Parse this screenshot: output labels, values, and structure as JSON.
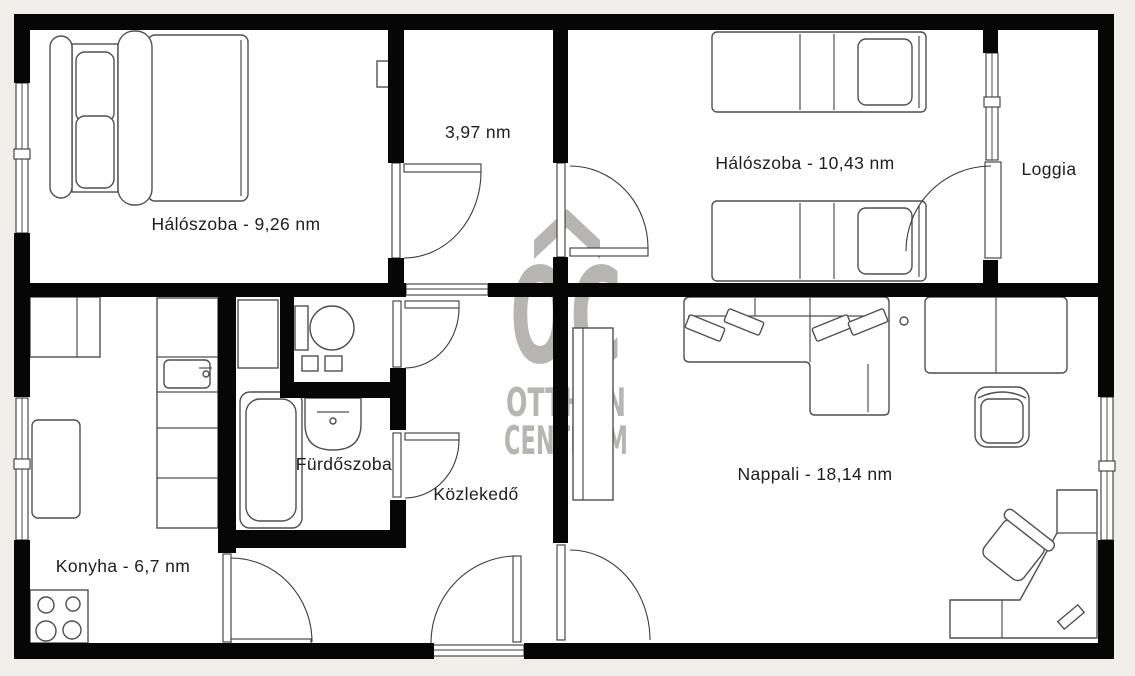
{
  "colors": {
    "background": "#efeee9",
    "wall": "#060606",
    "label": "#1d1d1d",
    "watermark": "#b6b5b2",
    "line": "#4f4f4f"
  },
  "watermark": {
    "logo": "OC",
    "line1": "OTTHON",
    "line2": "CENTRUM"
  },
  "rooms": [
    {
      "id": "bedroom-1",
      "label": "Hálószoba - 9,26 nm"
    },
    {
      "id": "inner-hall",
      "label": "3,97 nm"
    },
    {
      "id": "bedroom-2",
      "label": "Hálószoba - 10,43 nm"
    },
    {
      "id": "loggia",
      "label": "Loggia"
    },
    {
      "id": "bathroom",
      "label": "Fürdőszoba"
    },
    {
      "id": "corridor",
      "label": "Közlekedő"
    },
    {
      "id": "living-room",
      "label": "Nappali - 18,14 nm"
    },
    {
      "id": "kitchen",
      "label": "Konyha - 6,7 nm"
    }
  ]
}
